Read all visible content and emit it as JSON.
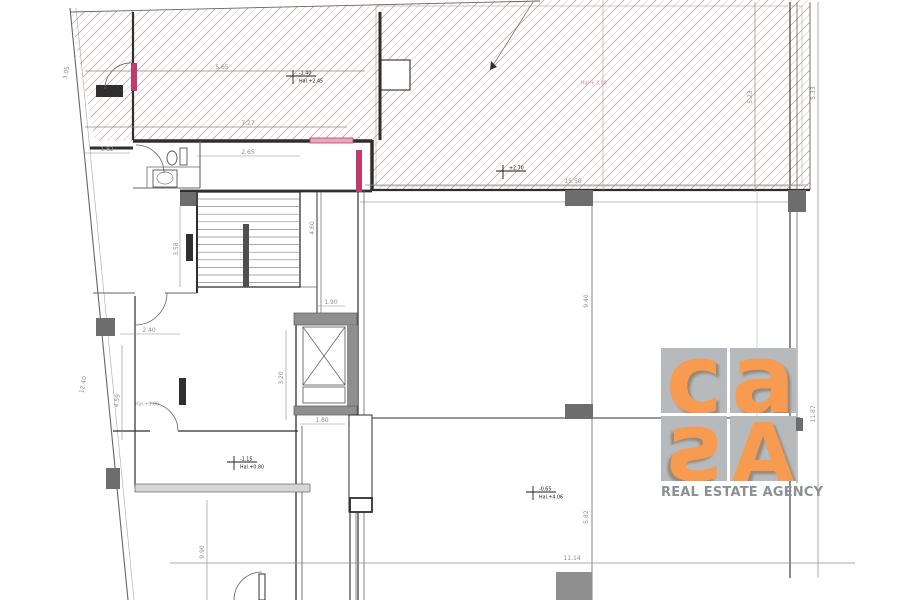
{
  "canvas": {
    "w": 900,
    "h": 600
  },
  "colors": {
    "wall": "#2f2f2f",
    "thin": "#666666",
    "light": "#a8a8a8",
    "dim": "#8c8c8c",
    "dimtext": "#8f8f8f",
    "column": "#6d6d6d",
    "gray_fill": "#8f8f8f",
    "red": "#c03a6a",
    "redfill": "#e8a8c0",
    "hatch": "#c79191",
    "hatch2": "#ddbcbc",
    "level": "#1a1a1a",
    "level_pink": "#c49090",
    "muted": "#9b9b9b",
    "band": "#d6d6d6",
    "white": "#ffffff",
    "logo_orange": "#f79b50",
    "logo_bg": "#b6babd",
    "logo_text": "#8b9094"
  },
  "logo": {
    "letters": [
      "c",
      "a",
      "s",
      "A"
    ],
    "tagline": "REAL ESTATE AGENCY"
  },
  "level_markers": [
    {
      "x": 296,
      "y": 76,
      "top": "-1.40",
      "bottom": "Hal.+2.45",
      "cross": true,
      "style": "default"
    },
    {
      "x": 506,
      "y": 171,
      "top": "+2.70",
      "bottom": "",
      "cross": true,
      "style": "default"
    },
    {
      "x": 237,
      "y": 462,
      "top": "-1.15",
      "bottom": "Hal.+0.80",
      "cross": true,
      "style": "default"
    },
    {
      "x": 536,
      "y": 492,
      "top": "-0.65",
      "bottom": "Hal.+4.06",
      "cross": true,
      "style": "default"
    },
    {
      "x": 578,
      "y": 86,
      "top": "Hal + 3.00",
      "bottom": "",
      "cross": false,
      "style": "pink"
    },
    {
      "x": 132,
      "y": 407,
      "top": "Hal.+0.80",
      "bottom": "",
      "cross": false,
      "style": "muted"
    }
  ],
  "dimensions": [
    {
      "text": "5.65",
      "x": 222,
      "y": 69,
      "rot": 0
    },
    {
      "text": "7.27",
      "x": 248,
      "y": 125,
      "rot": 0
    },
    {
      "text": "15.50",
      "x": 573,
      "y": 183,
      "rot": 0
    },
    {
      "text": "2.65",
      "x": 248,
      "y": 154,
      "rot": 0
    },
    {
      "text": "1.82",
      "x": 107,
      "y": 151,
      "rot": 0
    },
    {
      "text": "1.90",
      "x": 331,
      "y": 304,
      "rot": 0
    },
    {
      "text": "1.80",
      "x": 322,
      "y": 422,
      "rot": 0
    },
    {
      "text": "2.40",
      "x": 149,
      "y": 332,
      "rot": 0
    },
    {
      "text": "11.14",
      "x": 572,
      "y": 560,
      "rot": 0
    },
    {
      "text": "4.60",
      "x": 314,
      "y": 228,
      "rot": -90
    },
    {
      "text": "3.58",
      "x": 178,
      "y": 249,
      "rot": -90
    },
    {
      "text": "3.20",
      "x": 283,
      "y": 378,
      "rot": -90
    },
    {
      "text": "4.59",
      "x": 119,
      "y": 401,
      "rot": -83
    },
    {
      "text": "12.40",
      "x": 85,
      "y": 385,
      "rot": -80
    },
    {
      "text": "3.05",
      "x": 68,
      "y": 73,
      "rot": -80
    },
    {
      "text": "9.90",
      "x": 204,
      "y": 552,
      "rot": -90
    },
    {
      "text": "9.40",
      "x": 588,
      "y": 301,
      "rot": -90
    },
    {
      "text": "5.82",
      "x": 588,
      "y": 517,
      "rot": -90
    },
    {
      "text": "5.23",
      "x": 752,
      "y": 97,
      "rot": -90
    },
    {
      "text": "5.33",
      "x": 815,
      "y": 93,
      "rot": -90
    },
    {
      "text": "11.87",
      "x": 815,
      "y": 414,
      "rot": -90
    }
  ],
  "geometry": {
    "hatch_points": "70,12 540,0 810,0 810,190 372,190 372,141 95,141",
    "lines": [
      [
        70,
        8,
        128,
        600,
        1.1,
        "thin"
      ],
      [
        76,
        8,
        134,
        600,
        0.6,
        "light"
      ],
      [
        70,
        12,
        540,
        1,
        0.9,
        "thin"
      ],
      [
        810,
        2,
        810,
        190,
        0.9,
        "thin"
      ],
      [
        90,
        148,
        133,
        148,
        3,
        "wall"
      ],
      [
        133,
        141,
        310,
        141,
        3.5,
        "wall"
      ],
      [
        353,
        141,
        372,
        141,
        3.5,
        "wall"
      ],
      [
        372,
        140,
        372,
        191,
        3.5,
        "wall"
      ],
      [
        180,
        191,
        372,
        191,
        2.8,
        "wall"
      ],
      [
        372,
        190,
        810,
        190,
        2.2,
        "wall"
      ],
      [
        360,
        202,
        788,
        202,
        0.7,
        "light"
      ],
      [
        380,
        12,
        380,
        140,
        3,
        "wall"
      ],
      [
        133,
        12,
        133,
        140,
        2.2,
        "wall"
      ],
      [
        197,
        192,
        197,
        293,
        2,
        "wall"
      ],
      [
        296,
        313,
        296,
        600,
        1.3,
        "wall"
      ],
      [
        302,
        426,
        302,
        600,
        0.9,
        "thin"
      ],
      [
        358,
        190,
        358,
        600,
        1.2,
        "wall"
      ],
      [
        364,
        190,
        364,
        600,
        0.8,
        "thin"
      ],
      [
        360,
        418,
        800,
        418,
        1.1,
        "wall"
      ],
      [
        592,
        205,
        592,
        600,
        0.8,
        "thin"
      ],
      [
        790,
        2,
        790,
        578,
        1.1,
        "wall"
      ],
      [
        797,
        2,
        797,
        483,
        0.8,
        "thin"
      ],
      [
        113,
        431,
        150,
        431,
        1.2,
        "wall"
      ],
      [
        178,
        431,
        298,
        431,
        1.2,
        "wall"
      ],
      [
        135,
        296,
        135,
        487,
        1.2,
        "wall"
      ],
      [
        93,
        293,
        135,
        293,
        0.9,
        "thin"
      ],
      [
        165,
        293,
        197,
        293,
        0.9,
        "thin"
      ],
      [
        133,
        188,
        200,
        188,
        1.1,
        "thin"
      ],
      [
        200,
        141,
        200,
        188,
        1.1,
        "thin"
      ],
      [
        147,
        167,
        200,
        167,
        0.8,
        "thin"
      ],
      [
        147,
        167,
        147,
        188,
        0.8,
        "thin"
      ],
      [
        317,
        192,
        317,
        313,
        1,
        "wall"
      ],
      [
        321,
        192,
        321,
        313,
        0.7,
        "thin"
      ],
      [
        300,
        287,
        317,
        287,
        0.8,
        "thin"
      ],
      [
        197,
        287,
        300,
        287,
        1.1,
        "thin"
      ],
      [
        350,
        512,
        350,
        600,
        1.1,
        "wall"
      ],
      [
        356,
        512,
        356,
        600,
        0.8,
        "thin"
      ],
      [
        603,
        0,
        603,
        190,
        0.6,
        "light"
      ],
      [
        755,
        2,
        755,
        192,
        0.7,
        "dim"
      ],
      [
        757,
        192,
        757,
        428,
        0.5,
        "light"
      ],
      [
        818,
        2,
        818,
        578,
        0.7,
        "dim"
      ],
      [
        85,
        71,
        365,
        71,
        0.7,
        "dim"
      ],
      [
        85,
        127,
        347,
        127,
        0.7,
        "dim"
      ],
      [
        365,
        185,
        808,
        185,
        0.7,
        "dim"
      ],
      [
        170,
        563,
        855,
        563,
        0.7,
        "dim"
      ],
      [
        180,
        206,
        180,
        287,
        0.6,
        "dim"
      ],
      [
        286,
        330,
        286,
        420,
        0.6,
        "dim"
      ],
      [
        122,
        345,
        122,
        440,
        0.6,
        "dim"
      ],
      [
        207,
        500,
        207,
        600,
        0.6,
        "dim"
      ],
      [
        318,
        306,
        345,
        306,
        0.6,
        "dim"
      ],
      [
        300,
        424,
        345,
        424,
        0.6,
        "dim"
      ],
      [
        120,
        334,
        180,
        334,
        0.6,
        "dim"
      ],
      [
        85,
        153,
        130,
        153,
        0.6,
        "dim"
      ],
      [
        197,
        156,
        300,
        156,
        0.6,
        "dim"
      ],
      [
        349,
        460,
        372,
        460,
        0.6,
        "thin"
      ],
      [
        390,
        60,
        390,
        90,
        0.6,
        "thin"
      ],
      [
        397,
        60,
        397,
        90,
        0.6,
        "thin"
      ],
      [
        404,
        60,
        404,
        90,
        0.6,
        "thin"
      ],
      [
        303,
        327,
        345,
        385,
        0.8,
        "thin"
      ],
      [
        345,
        327,
        303,
        385,
        0.8,
        "thin"
      ]
    ],
    "rects": [
      [
        376,
        6,
        426,
        180,
        "",
        "light",
        0.6
      ],
      [
        180,
        192,
        18,
        14,
        "column",
        "",
        0
      ],
      [
        565,
        190,
        28,
        16,
        "column",
        "",
        0
      ],
      [
        788,
        190,
        18,
        22,
        "column",
        "",
        0
      ],
      [
        565,
        404,
        28,
        15,
        "column",
        "",
        0
      ],
      [
        788,
        418,
        15,
        13,
        "column",
        "",
        0
      ],
      [
        96,
        318,
        19,
        18,
        "column",
        "",
        0
      ],
      [
        106,
        468,
        14,
        21,
        "column",
        "",
        0
      ],
      [
        556,
        572,
        36,
        28,
        "gray_fill",
        "",
        0
      ],
      [
        294,
        313,
        63,
        12,
        "gray_fill",
        "thin",
        0.8
      ],
      [
        347,
        325,
        10,
        82,
        "gray_fill",
        "",
        0
      ],
      [
        294,
        406,
        63,
        9,
        "gray_fill",
        "thin",
        0.8
      ],
      [
        303,
        327,
        42,
        58,
        "",
        "thin",
        0.9
      ],
      [
        303,
        387,
        42,
        16,
        "",
        "thin",
        0.9
      ],
      [
        381,
        60,
        29,
        30,
        "white",
        "wall",
        1.1
      ],
      [
        349,
        415,
        23,
        97,
        "white",
        "wall",
        1
      ],
      [
        350,
        498,
        22,
        14,
        "white",
        "wall",
        1.8
      ],
      [
        96,
        85,
        27,
        12,
        "wall",
        "",
        0
      ],
      [
        186,
        234,
        7,
        27,
        "wall",
        "",
        0
      ],
      [
        179,
        378,
        7,
        27,
        "wall",
        "",
        0
      ],
      [
        131,
        63,
        6,
        28,
        "red",
        "",
        0
      ],
      [
        310,
        138,
        43,
        5,
        "redfill",
        "red",
        0.8
      ],
      [
        356,
        150,
        6,
        42,
        "red",
        "",
        0
      ],
      [
        135,
        484,
        175,
        8,
        "band",
        "thin",
        0.7
      ],
      [
        197,
        192,
        103,
        95,
        "",
        "wall",
        1.3
      ],
      [
        259,
        574,
        6,
        26,
        "",
        "wall",
        1
      ]
    ],
    "paths": [
      [
        "M136,145 A28,28 0 0 1 164,173",
        "thin",
        0.8,
        ""
      ],
      [
        "M105,89 A26,26 0 0 1 133,63",
        "thin",
        0.8,
        ""
      ],
      [
        "M167,293 A32,32 0 0 1 135,325",
        "thin",
        0.8,
        ""
      ],
      [
        "M150,403 A28,28 0 0 1 178,431",
        "thin",
        0.8,
        ""
      ],
      [
        "M234,600 A28,28 0 0 1 262,572",
        "thin",
        0.8,
        ""
      ],
      [
        "M533,2 L490,70",
        "thin",
        0.7,
        ""
      ],
      [
        "M490,70 l1,-9 l6,6 z",
        "",
        0,
        "wall"
      ]
    ],
    "stairs": {
      "x": 198,
      "y": 199,
      "w": 101,
      "stepH": 7.6,
      "count": 12,
      "rail": {
        "x": 243,
        "y": 224,
        "w": 6,
        "h": 63
      }
    },
    "fixtures": {
      "toilet_tank": [
        180,
        148,
        7,
        17
      ],
      "toilet_bowl": {
        "cx": 172,
        "cy": 158,
        "rx": 5,
        "ry": 7
      },
      "sink_box": [
        153,
        170,
        24,
        17
      ],
      "sink_basin": {
        "cx": 165,
        "cy": 178,
        "rx": 8,
        "ry": 6
      }
    }
  }
}
